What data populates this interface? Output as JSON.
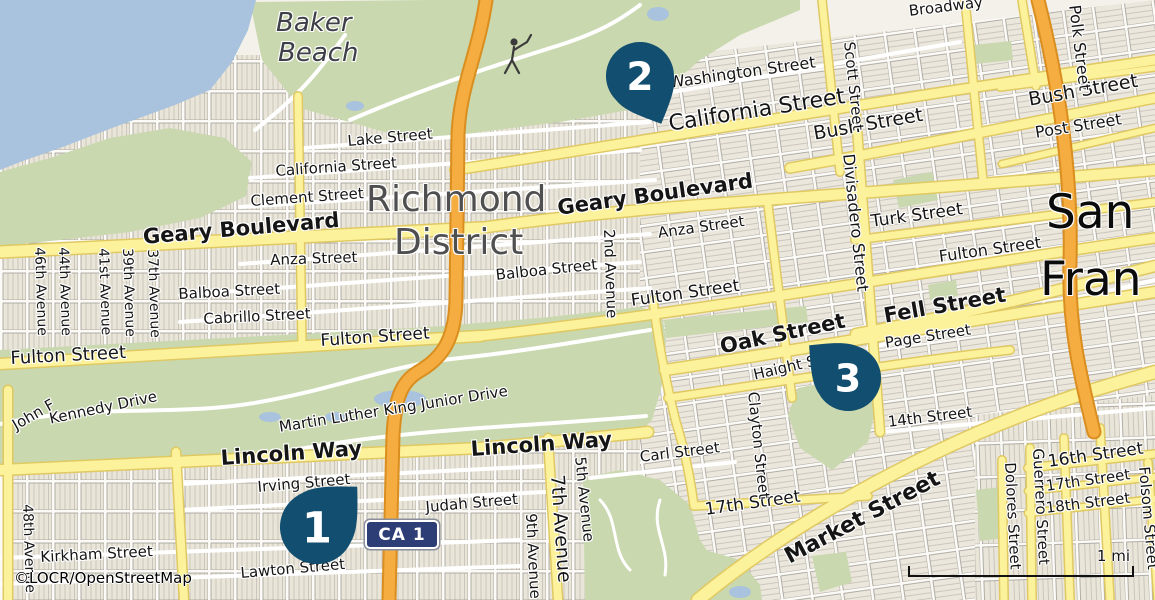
{
  "map": {
    "attribution": "©LOCR/OpenStreetMap",
    "scale_label": "1 mi",
    "shield_label": "CA 1",
    "colors": {
      "water": "#A9C2DD",
      "park": "#C9D8AE",
      "road_yellow": "#FCF29B",
      "road_yellow_casing": "#E0C963",
      "road_orange": "#F5AC40",
      "road_orange_casing": "#D98E1F",
      "marker": "#114E6F",
      "shield_bg": "#2D3E76",
      "city_label": "#4F4F4F",
      "background": "#F3F1EA"
    },
    "markers": [
      {
        "label": "1",
        "cx": 317,
        "cy": 527,
        "r": 37,
        "angle": -135
      },
      {
        "label": "2",
        "cx": 640,
        "cy": 76,
        "r": 34,
        "angle": -24
      },
      {
        "label": "3",
        "cx": 848,
        "cy": 378,
        "r": 33,
        "angle": 130
      }
    ],
    "labels": [
      {
        "t": "Baker",
        "x": 276,
        "y": 10,
        "s": 26,
        "i": 1,
        "c": "#3D4047"
      },
      {
        "t": "Beach",
        "x": 278,
        "y": 40,
        "s": 26,
        "i": 1,
        "c": "#3D4047"
      },
      {
        "t": "Richmond",
        "x": 366,
        "y": 181,
        "s": 36,
        "c": "#4F4F4F"
      },
      {
        "t": "District",
        "x": 394,
        "y": 224,
        "s": 36,
        "c": "#4F4F4F"
      },
      {
        "t": "San",
        "x": 1046,
        "y": 188,
        "s": 47,
        "c": "#0B0B0B"
      },
      {
        "t": "Fran",
        "x": 1040,
        "y": 255,
        "s": 47,
        "c": "#0B0B0B"
      },
      {
        "t": "Broadway",
        "x": 908,
        "y": 4,
        "r": -7,
        "s": 15
      },
      {
        "t": "Washington Street",
        "x": 668,
        "y": 75,
        "r": -8,
        "s": 16
      },
      {
        "t": "California Street",
        "x": 667,
        "y": 113,
        "r": -9,
        "s": 22
      },
      {
        "t": "Bush Street",
        "x": 812,
        "y": 125,
        "r": -10,
        "s": 19
      },
      {
        "t": "Bush Street",
        "x": 1027,
        "y": 91,
        "r": -10,
        "s": 19
      },
      {
        "t": "Post Street",
        "x": 1034,
        "y": 125,
        "r": -9,
        "s": 16
      },
      {
        "t": "Lake Street",
        "x": 347,
        "y": 134,
        "r": -5,
        "s": 15
      },
      {
        "t": "California Street",
        "x": 275,
        "y": 164,
        "r": -4,
        "s": 15
      },
      {
        "t": "Clement Street",
        "x": 250,
        "y": 194,
        "r": -4,
        "s": 15
      },
      {
        "t": "Geary Boulevard",
        "x": 142,
        "y": 226,
        "r": -5,
        "s": 21,
        "b": 1
      },
      {
        "t": "Geary Boulevard",
        "x": 556,
        "y": 197,
        "r": -8,
        "s": 21,
        "b": 1
      },
      {
        "t": "Anza Street",
        "x": 270,
        "y": 253,
        "r": -2,
        "s": 15
      },
      {
        "t": "Anza Street",
        "x": 657,
        "y": 226,
        "r": -8,
        "s": 15
      },
      {
        "t": "Balboa Street",
        "x": 178,
        "y": 287,
        "r": -3,
        "s": 15
      },
      {
        "t": "Balboa Street",
        "x": 495,
        "y": 268,
        "r": -6,
        "s": 15
      },
      {
        "t": "Cabrillo Street",
        "x": 203,
        "y": 312,
        "r": -3,
        "s": 15
      },
      {
        "t": "Fulton Street",
        "x": 10,
        "y": 350,
        "r": -3,
        "s": 18
      },
      {
        "t": "Fulton Street",
        "x": 320,
        "y": 333,
        "r": -4,
        "s": 17
      },
      {
        "t": "Fulton Street",
        "x": 630,
        "y": 293,
        "r": -8,
        "s": 17
      },
      {
        "t": "Fulton Street",
        "x": 938,
        "y": 249,
        "r": -8,
        "s": 16
      },
      {
        "t": "Turk Street",
        "x": 870,
        "y": 214,
        "r": -8,
        "s": 17
      },
      {
        "t": "Fell Street",
        "x": 882,
        "y": 305,
        "r": -10,
        "s": 21,
        "b": 1
      },
      {
        "t": "Page Street",
        "x": 884,
        "y": 336,
        "r": -9,
        "s": 15
      },
      {
        "t": "Oak Street",
        "x": 718,
        "y": 336,
        "r": -12,
        "s": 21,
        "b": 1
      },
      {
        "t": "Haight Street",
        "x": 752,
        "y": 368,
        "r": -13,
        "s": 15
      },
      {
        "t": "14th Street",
        "x": 887,
        "y": 415,
        "r": -7,
        "s": 15
      },
      {
        "t": "Carl Street",
        "x": 639,
        "y": 450,
        "r": -7,
        "s": 15
      },
      {
        "t": "17th Street",
        "x": 704,
        "y": 502,
        "r": -8,
        "s": 17
      },
      {
        "t": "Market Street",
        "x": 781,
        "y": 548,
        "r": -28,
        "s": 22,
        "b": 1
      },
      {
        "t": "16th Street",
        "x": 1047,
        "y": 454,
        "r": -8,
        "s": 17
      },
      {
        "t": "17th Street",
        "x": 1045,
        "y": 479,
        "r": -8,
        "s": 15
      },
      {
        "t": "18th Street",
        "x": 1045,
        "y": 501,
        "r": -7,
        "s": 15
      },
      {
        "t": "Lincoln Way",
        "x": 220,
        "y": 447,
        "r": -4,
        "s": 21,
        "b": 1
      },
      {
        "t": "Lincoln Way",
        "x": 470,
        "y": 438,
        "r": -4,
        "s": 21,
        "b": 1
      },
      {
        "t": "Irving Street",
        "x": 257,
        "y": 480,
        "r": -5,
        "s": 15
      },
      {
        "t": "Judah Street",
        "x": 425,
        "y": 500,
        "r": -5,
        "s": 15
      },
      {
        "t": "Kirkham Street",
        "x": 40,
        "y": 550,
        "r": -3,
        "s": 15
      },
      {
        "t": "Lawton Street",
        "x": 240,
        "y": 566,
        "r": -5,
        "s": 15
      },
      {
        "t": "John F",
        "x": 10,
        "y": 420,
        "r": -30,
        "s": 15
      },
      {
        "t": "Kennedy Drive",
        "x": 48,
        "y": 412,
        "r": -12,
        "s": 15
      },
      {
        "t": "Martin Luther King Junior Drive",
        "x": 278,
        "y": 420,
        "r": -9,
        "s": 15
      },
      {
        "t": "Polk Street",
        "x": 1082,
        "y": 4,
        "r": 83,
        "s": 16
      },
      {
        "t": "Scott Street",
        "x": 856,
        "y": 41,
        "r": 84,
        "s": 15
      },
      {
        "t": "Divisadero Street",
        "x": 856,
        "y": 153,
        "r": 84,
        "s": 16
      },
      {
        "t": "2nd Avenue",
        "x": 616,
        "y": 229,
        "r": 88,
        "s": 15
      },
      {
        "t": "Clayton Street",
        "x": 760,
        "y": 391,
        "r": 84,
        "s": 15
      },
      {
        "t": "Guerrero Street",
        "x": 1045,
        "y": 448,
        "r": 87,
        "s": 15
      },
      {
        "t": "Dolores Street",
        "x": 1017,
        "y": 462,
        "r": 87,
        "s": 15
      },
      {
        "t": "Folsom Street",
        "x": 1151,
        "y": 466,
        "r": 85,
        "s": 15
      },
      {
        "t": "48th Avenue",
        "x": 34,
        "y": 504,
        "r": 88,
        "s": 14
      },
      {
        "t": "46th Avenue",
        "x": 46,
        "y": 247,
        "r": 88,
        "s": 14
      },
      {
        "t": "44th Avenue",
        "x": 70,
        "y": 247,
        "r": 88,
        "s": 14
      },
      {
        "t": "41st Avenue",
        "x": 110,
        "y": 248,
        "r": 88,
        "s": 14
      },
      {
        "t": "39th Avenue",
        "x": 134,
        "y": 248,
        "r": 88,
        "s": 14
      },
      {
        "t": "37th Avenue",
        "x": 159,
        "y": 249,
        "r": 88,
        "s": 14
      },
      {
        "t": "9th Avenue",
        "x": 538,
        "y": 513,
        "r": 87,
        "s": 15
      },
      {
        "t": "7th Avenue",
        "x": 566,
        "y": 474,
        "r": 86,
        "s": 19
      },
      {
        "t": "5th Avenue",
        "x": 587,
        "y": 456,
        "r": 84,
        "s": 15
      }
    ]
  }
}
